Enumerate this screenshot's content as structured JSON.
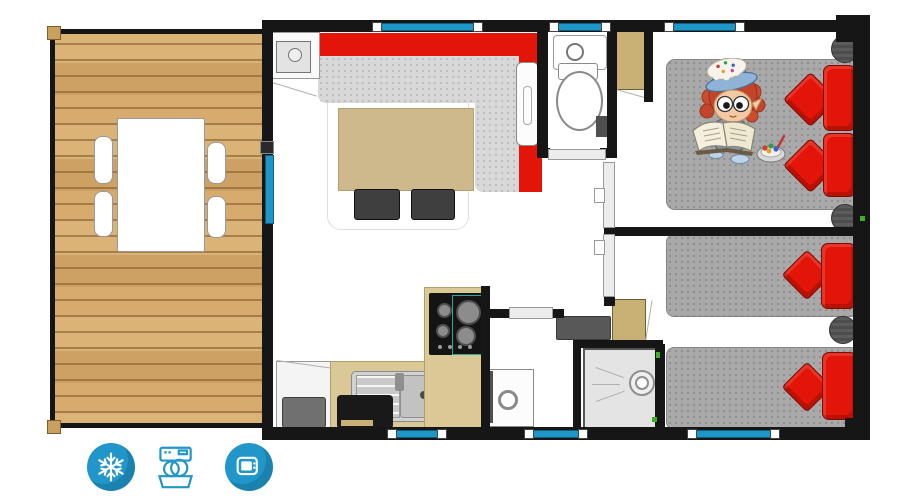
{
  "plan_type": "mobile-home-floor-plan",
  "colors": {
    "wall": "#161616",
    "floor": "#ffffff",
    "wood": "#d7ae6f",
    "wood-dark": "#bc8e54",
    "glass": "#1e96c8",
    "glass-dark": "#0d5f80",
    "sofa-red": "#e21508",
    "red-dark": "#7e0a02",
    "seat-gray": "#d8d8d8",
    "mattress-gray": "#a9a9a9",
    "table-tan": "#cdb98b",
    "counter-tan": "#dac897",
    "wood-trim": "#b19e6b",
    "wardrobe-tan": "#c9b175",
    "shelf-gray": "#585858",
    "appliance-black": "#191919",
    "icon-blue": "#2196c8",
    "door-gray": "#ececec",
    "accent-green": "#3fae29"
  },
  "rooms": [
    {
      "id": "terrace",
      "furniture": [
        "dining-table",
        "chair",
        "chair",
        "chair",
        "chair",
        "deck-posts"
      ]
    },
    {
      "id": "living-room",
      "furniture": [
        "corner-sofa",
        "coffee-table",
        "stool",
        "stool",
        "rug",
        "wall-radiator",
        "tall-cabinet"
      ]
    },
    {
      "id": "kitchen",
      "furniture": [
        "fridge",
        "sink-with-drainboard",
        "counter",
        "black-appliance",
        "cooktop-4-burners"
      ]
    },
    {
      "id": "wc",
      "furniture": [
        "hand-basin",
        "toilet",
        "wall-box",
        "sliding-door"
      ]
    },
    {
      "id": "bathroom",
      "furniture": [
        "vanity-sink",
        "dark-shelf",
        "storage-cabinet",
        "shower-tray",
        "door"
      ]
    },
    {
      "id": "hallway",
      "furniture": [
        "sliding-door",
        "sliding-door"
      ]
    },
    {
      "id": "bedroom-double",
      "furniture": [
        "double-bed",
        "red-pillows",
        "nightstand",
        "nightstand",
        "wardrobe",
        "cartoon-child-illustration",
        "candy-bowl"
      ]
    },
    {
      "id": "bedroom-twin",
      "furniture": [
        "single-bed",
        "single-bed",
        "red-pillows",
        "nightstand"
      ]
    }
  ],
  "openings": {
    "top_windows": 3,
    "bottom_windows": 3,
    "terrace_glass_door": 1
  },
  "amenities": [
    {
      "id": "air-conditioning",
      "icon": "snowflake-icon",
      "style": "filled-circle",
      "color": "#2196c8"
    },
    {
      "id": "dishwasher",
      "icon": "dishwasher-icon",
      "style": "outline",
      "color": "#2196c8"
    },
    {
      "id": "tv",
      "icon": "tv-icon",
      "style": "filled-circle",
      "color": "#2196c8"
    }
  ]
}
